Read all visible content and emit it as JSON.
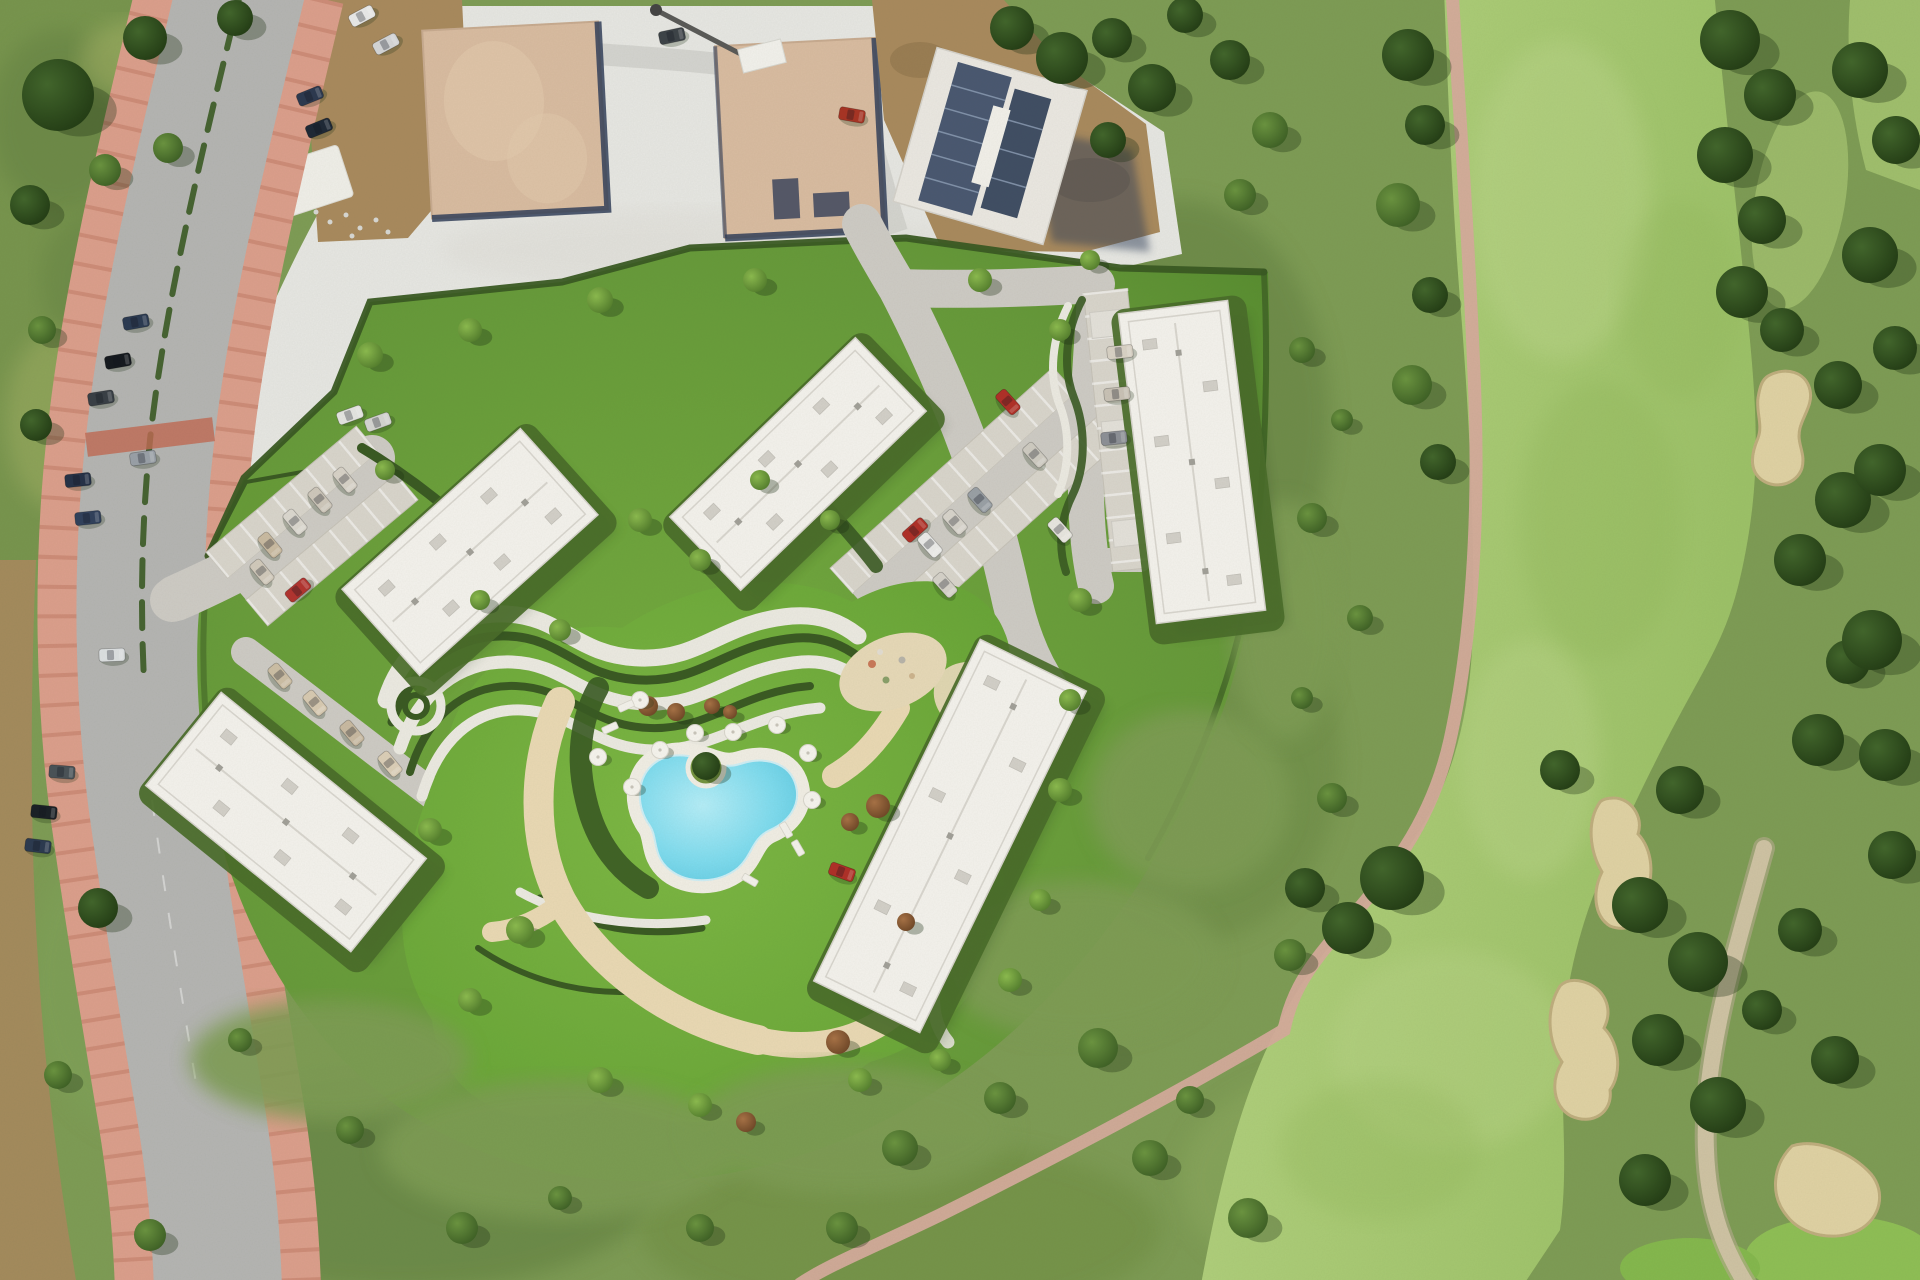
{
  "meta": {
    "title": "Aerial photograph: rendered residential development with kidney-shaped pool, five white apartment blocks, access road on the left and golf course fairway with sand bunkers on the right",
    "width": 1920,
    "height": 1280
  },
  "palette": {
    "scrub": "#7e9c55",
    "scrubDark": "#657f41",
    "scrubLight": "#96b06a",
    "scrubYellow": "#a7b468",
    "hedge": "#3a5a23",
    "fairway": "#a9c873",
    "fairwayLight": "#bad488",
    "fairwayDark": "#93b85c",
    "sand": "#e0d2a4",
    "sandEdge": "#bfae7e",
    "cartPath": "#d5ab9c",
    "trailTan": "#cfc3a4",
    "road": "#b5b5b3",
    "devRoad": "#cecbc5",
    "parkBay": "#d9d5cc",
    "gravel": "#e7e7e3",
    "sidewalk": "#dc9f8c",
    "sidewalkStripe": "#bc7660",
    "crosswalk": "#c26a54",
    "plaza": "#e7d9b8",
    "sandPath": "#ead9b4",
    "dirt": "#a98a5e",
    "dirtDark": "#8c6f47",
    "pad": "#d9bca1",
    "navy": "#333f5a",
    "building": "#f4f2ed",
    "roofLine": "#d9d6cf",
    "roofUnit": "#d3d0c9",
    "pool": "#8fdff0",
    "deck": "#f1eee5"
  },
  "scene": {
    "buildings": [
      {
        "id": "building-northwest",
        "cx": 470,
        "cy": 552,
        "w": 240,
        "h": 116,
        "rot": -42
      },
      {
        "id": "building-north",
        "cx": 798,
        "cy": 464,
        "w": 258,
        "h": 102,
        "rot": -44
      },
      {
        "id": "building-northeast",
        "cx": 1192,
        "cy": 462,
        "w": 110,
        "h": 312,
        "rot": -7
      },
      {
        "id": "building-southwest",
        "cx": 286,
        "cy": 822,
        "w": 264,
        "h": 120,
        "rot": 39
      },
      {
        "id": "building-southeast",
        "cx": 950,
        "cy": 836,
        "w": 118,
        "h": 380,
        "rot": 26
      }
    ],
    "trees": [
      [
        1408,
        55,
        26,
        "d"
      ],
      [
        1425,
        125,
        20,
        "d"
      ],
      [
        1398,
        205,
        22,
        "m"
      ],
      [
        1430,
        295,
        18,
        "d"
      ],
      [
        1412,
        385,
        20,
        "m"
      ],
      [
        1438,
        462,
        18,
        "d"
      ],
      [
        1730,
        40,
        30,
        "d"
      ],
      [
        1770,
        95,
        26,
        "d"
      ],
      [
        1725,
        155,
        28,
        "d"
      ],
      [
        1762,
        220,
        24,
        "d"
      ],
      [
        1742,
        292,
        26,
        "d"
      ],
      [
        1782,
        330,
        22,
        "d"
      ],
      [
        1838,
        385,
        24,
        "d"
      ],
      [
        1843,
        500,
        28,
        "d"
      ],
      [
        1800,
        560,
        26,
        "d"
      ],
      [
        1848,
        662,
        22,
        "d"
      ],
      [
        1818,
        740,
        26,
        "d"
      ],
      [
        1560,
        770,
        20,
        "d"
      ],
      [
        1680,
        790,
        24,
        "d"
      ],
      [
        1640,
        905,
        28,
        "d"
      ],
      [
        1698,
        962,
        30,
        "d"
      ],
      [
        1658,
        1040,
        26,
        "d"
      ],
      [
        1718,
        1105,
        28,
        "d"
      ],
      [
        1645,
        1180,
        26,
        "d"
      ],
      [
        1860,
        70,
        28,
        "d"
      ],
      [
        1896,
        140,
        24,
        "d"
      ],
      [
        1870,
        255,
        28,
        "d"
      ],
      [
        1895,
        348,
        22,
        "d"
      ],
      [
        1880,
        470,
        26,
        "d"
      ],
      [
        1872,
        640,
        30,
        "d"
      ],
      [
        1885,
        755,
        26,
        "d"
      ],
      [
        1892,
        855,
        24,
        "d"
      ],
      [
        1800,
        930,
        22,
        "d"
      ],
      [
        1762,
        1010,
        20,
        "d"
      ],
      [
        1835,
        1060,
        24,
        "d"
      ],
      [
        1392,
        878,
        32,
        "d"
      ],
      [
        1348,
        928,
        26,
        "d"
      ],
      [
        1305,
        888,
        20,
        "d"
      ],
      [
        1290,
        955,
        16,
        "m"
      ],
      [
        1302,
        350,
        13,
        "m"
      ],
      [
        1342,
        420,
        11,
        "m"
      ],
      [
        1312,
        518,
        15,
        "m"
      ],
      [
        1360,
        618,
        13,
        "m"
      ],
      [
        1302,
        698,
        11,
        "m"
      ],
      [
        1332,
        798,
        15,
        "m"
      ],
      [
        1012,
        28,
        22,
        "d"
      ],
      [
        1062,
        58,
        26,
        "d"
      ],
      [
        1112,
        38,
        20,
        "d"
      ],
      [
        1152,
        88,
        24,
        "d"
      ],
      [
        1108,
        140,
        18,
        "d"
      ],
      [
        1185,
        15,
        18,
        "d"
      ],
      [
        1230,
        60,
        20,
        "d"
      ],
      [
        1270,
        130,
        18,
        "m"
      ],
      [
        1240,
        195,
        16,
        "m"
      ],
      [
        58,
        95,
        36,
        "d"
      ],
      [
        145,
        38,
        22,
        "d"
      ],
      [
        30,
        205,
        20,
        "d"
      ],
      [
        105,
        170,
        16,
        "m"
      ],
      [
        42,
        330,
        14,
        "m"
      ],
      [
        168,
        148,
        15,
        "m"
      ],
      [
        36,
        425,
        16,
        "d"
      ],
      [
        98,
        908,
        20,
        "d"
      ],
      [
        58,
        1075,
        14,
        "m"
      ],
      [
        150,
        1235,
        16,
        "m"
      ],
      [
        235,
        18,
        18,
        "d"
      ],
      [
        370,
        355,
        13,
        "l"
      ],
      [
        470,
        330,
        12,
        "l"
      ],
      [
        600,
        300,
        13,
        "l"
      ],
      [
        755,
        280,
        12,
        "l"
      ],
      [
        385,
        470,
        10,
        "l"
      ],
      [
        640,
        520,
        12,
        "l"
      ],
      [
        700,
        560,
        11,
        "l"
      ],
      [
        480,
        600,
        10,
        "l"
      ],
      [
        560,
        630,
        11,
        "l"
      ],
      [
        430,
        830,
        12,
        "l"
      ],
      [
        520,
        930,
        14,
        "l"
      ],
      [
        470,
        1000,
        12,
        "l"
      ],
      [
        600,
        1080,
        13,
        "l"
      ],
      [
        700,
        1105,
        12,
        "l"
      ],
      [
        860,
        1080,
        12,
        "l"
      ],
      [
        940,
        1060,
        11,
        "l"
      ],
      [
        1010,
        980,
        12,
        "l"
      ],
      [
        1040,
        900,
        11,
        "l"
      ],
      [
        1060,
        790,
        12,
        "l"
      ],
      [
        1070,
        700,
        11,
        "l"
      ],
      [
        1080,
        600,
        12,
        "l"
      ],
      [
        760,
        480,
        10,
        "l"
      ],
      [
        830,
        520,
        10,
        "l"
      ],
      [
        980,
        280,
        12,
        "l"
      ],
      [
        1060,
        330,
        11,
        "l"
      ],
      [
        1090,
        260,
        10,
        "l"
      ],
      [
        706,
        766,
        14,
        "d"
      ],
      [
        900,
        1148,
        18,
        "m"
      ],
      [
        1000,
        1098,
        16,
        "m"
      ],
      [
        1098,
        1048,
        20,
        "m"
      ],
      [
        842,
        1228,
        16,
        "m"
      ],
      [
        700,
        1228,
        14,
        "m"
      ],
      [
        560,
        1198,
        12,
        "m"
      ],
      [
        462,
        1228,
        16,
        "m"
      ],
      [
        1150,
        1158,
        18,
        "m"
      ],
      [
        1248,
        1218,
        20,
        "m"
      ],
      [
        1190,
        1100,
        14,
        "m"
      ],
      [
        350,
        1130,
        14,
        "m"
      ],
      [
        240,
        1040,
        12,
        "m"
      ],
      [
        648,
        706,
        10,
        "r"
      ],
      [
        676,
        712,
        9,
        "r"
      ],
      [
        878,
        806,
        12,
        "r"
      ],
      [
        850,
        822,
        9,
        "r"
      ],
      [
        838,
        1042,
        12,
        "r"
      ],
      [
        746,
        1122,
        10,
        "r"
      ],
      [
        906,
        922,
        9,
        "r"
      ],
      [
        712,
        706,
        8,
        "r"
      ],
      [
        730,
        712,
        7,
        "r"
      ]
    ],
    "cars": [
      [
        136,
        322,
        -10,
        "#2b3a52"
      ],
      [
        118,
        361,
        -10,
        "#15191f"
      ],
      [
        101,
        398,
        -9,
        "#393f46"
      ],
      [
        78,
        480,
        -6,
        "#263248"
      ],
      [
        88,
        518,
        -6,
        "#31415c"
      ],
      [
        143,
        458,
        -8,
        "#9aa0a8"
      ],
      [
        112,
        655,
        -2,
        "#dde0e2"
      ],
      [
        62,
        772,
        4,
        "#4a5258"
      ],
      [
        44,
        812,
        6,
        "#1a2026"
      ],
      [
        38,
        846,
        7,
        "#2c3a50"
      ],
      [
        310,
        96,
        -22,
        "#2d3950"
      ],
      [
        319,
        128,
        -22,
        "#1e2836"
      ],
      [
        362,
        16,
        -28,
        "#e9e9e9"
      ],
      [
        386,
        44,
        -28,
        "#d5d6d8"
      ],
      [
        672,
        36,
        -12,
        "#3d4348"
      ],
      [
        852,
        115,
        10,
        "#a83424"
      ],
      [
        350,
        415,
        -20,
        "#e5e5e2"
      ],
      [
        378,
        422,
        -20,
        "#d5d5d2"
      ],
      [
        298,
        590,
        -40,
        "#b23430"
      ],
      [
        270,
        545,
        50,
        "#cabba2"
      ],
      [
        295,
        522,
        50,
        "#dcd8d0"
      ],
      [
        320,
        500,
        50,
        "#cfc8bc"
      ],
      [
        345,
        480,
        50,
        "#d8d2c8"
      ],
      [
        262,
        572,
        50,
        "#d2cabc"
      ],
      [
        280,
        676,
        50,
        "#cdbfa6"
      ],
      [
        315,
        703,
        50,
        "#d8cab2"
      ],
      [
        352,
        733,
        50,
        "#c9baa2"
      ],
      [
        390,
        764,
        50,
        "#dccfb8"
      ],
      [
        915,
        530,
        -42,
        "#b03028"
      ],
      [
        1008,
        402,
        48,
        "#b03028"
      ],
      [
        930,
        545,
        48,
        "#ececea"
      ],
      [
        955,
        522,
        48,
        "#d8d4cc"
      ],
      [
        980,
        500,
        48,
        "#9aa0a6"
      ],
      [
        1035,
        455,
        48,
        "#cfcbc2"
      ],
      [
        1060,
        530,
        48,
        "#e8e6e0"
      ],
      [
        945,
        585,
        48,
        "#d6d2ca"
      ],
      [
        1120,
        352,
        -6,
        "#d9d2c6"
      ],
      [
        1117,
        394,
        -6,
        "#c9c2b6"
      ],
      [
        1114,
        438,
        -6,
        "#8d9097"
      ],
      [
        842,
        872,
        20,
        "#b03028"
      ]
    ],
    "umbrellas": [
      [
        695,
        733
      ],
      [
        733,
        732
      ],
      [
        777,
        725
      ],
      [
        660,
        750
      ],
      [
        632,
        787
      ],
      [
        808,
        753
      ],
      [
        812,
        800
      ],
      [
        640,
        700
      ],
      [
        598,
        757
      ]
    ],
    "loungers": [
      [
        626,
        706,
        -24
      ],
      [
        610,
        728,
        -24
      ],
      [
        786,
        830,
        60
      ],
      [
        798,
        848,
        60
      ],
      [
        750,
        880,
        30
      ]
    ]
  }
}
